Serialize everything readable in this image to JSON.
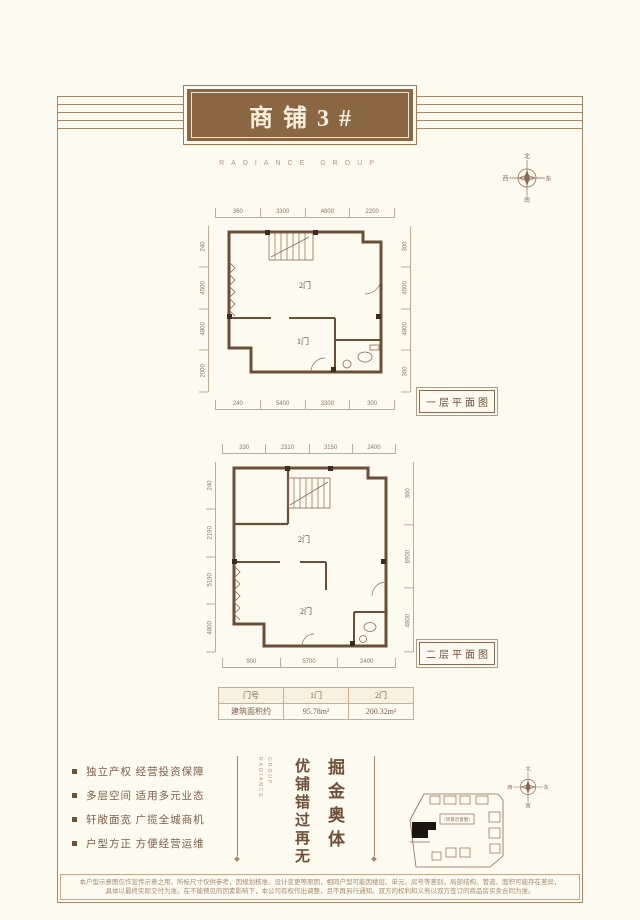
{
  "header": {
    "title": "商铺3#",
    "subtitle": "RADIANCE GROUP"
  },
  "compass": {
    "north": "北",
    "south": "南",
    "west": "西",
    "east": "东"
  },
  "plans": {
    "first": {
      "label": "一层平面图",
      "rooms": {
        "upper": "2门",
        "lower": "1门"
      },
      "dims_top": [
        "360",
        "3300",
        "4800",
        "2200"
      ],
      "dims_left": [
        "240",
        "4500",
        "4800",
        "2000"
      ],
      "dims_right": [
        "300",
        "4500",
        "4800",
        "300"
      ],
      "dims_bottom": [
        "240",
        "5400",
        "3300",
        "300"
      ]
    },
    "second": {
      "label": "二层平面图",
      "rooms": {
        "upper": "2门",
        "lower": "2门"
      },
      "dims_top": [
        "330",
        "2310",
        "3150",
        "2400"
      ],
      "dims_left": [
        "240",
        "2190",
        "5190",
        "4800"
      ],
      "dims_right": [
        "300",
        "6900",
        "4800"
      ],
      "dims_bottom": [
        "900",
        "5700",
        "2400"
      ]
    }
  },
  "table": {
    "headers": [
      "门号",
      "1门",
      "2门"
    ],
    "row_label": "建筑面积约",
    "row_values": [
      "95.78m²",
      "200.32m²"
    ]
  },
  "features": [
    "独立产权 经营投资保障",
    "多层空间 适用多元业态",
    "轩敞面宽 广揽全城商机",
    "户型方正 方便经营运维"
  ],
  "slogan": {
    "col_right": "掘金奥体",
    "col_left": "优铺错过再无",
    "brand_vertical_1": "RADIANCE",
    "brand_vertical_2": "GROUP"
  },
  "sitemap": {
    "label": "（项目示意图）"
  },
  "disclaimer": {
    "line1": "本户型示意图仅作宣传示意之用，所标尺寸仅供参考，因规划核准、设计变更等原因，相同户型可能因楼层、单元、房号等差别，局部结构、管道、面积可能存在差异，",
    "line2": "具体以最终实际交付为准。在不能预见的因素影响下，本公司有权作出调整，且不再另行通知。双方的权利和义务以双方签订的商品房买卖合同为准。"
  },
  "colors": {
    "accent": "#8a6742",
    "line": "#a3876b",
    "wall": "#6b4e38"
  }
}
